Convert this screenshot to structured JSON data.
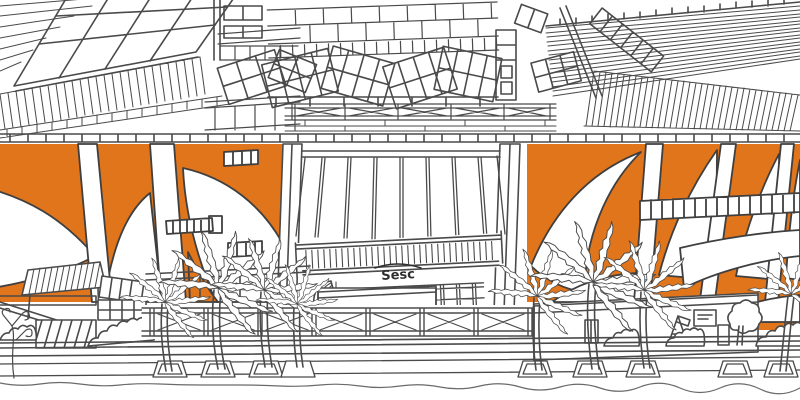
{
  "scene": {
    "type": "hand-drawn line illustration",
    "description": "Black-and-white architectural sketch of a Sesc cultural center facade: rooftops with tilted solar panel arrays and hatched roof planes, orange facade panels decorated with large white leaf shapes, a central building with vertical slats and a louvered canopy bearing the Sesc sign, a street-level truss, palm trees, planters, awnings and kiosks along the sidewalk",
    "sign": {
      "text": "Sesc"
    },
    "colors": {
      "accent_orange": "#E0751C",
      "line": "#4A4A4A",
      "background": "#FFFFFF"
    },
    "elements": [
      "skylight roof grid",
      "solar panel arrays",
      "hatched roof planes",
      "roof truss",
      "orange leaf-pattern facade panels",
      "louvered canopy",
      "Sesc sign",
      "window bands",
      "street truss",
      "palm trees",
      "striped awning",
      "planters and sidewalk",
      "kiosks and bushes"
    ]
  }
}
